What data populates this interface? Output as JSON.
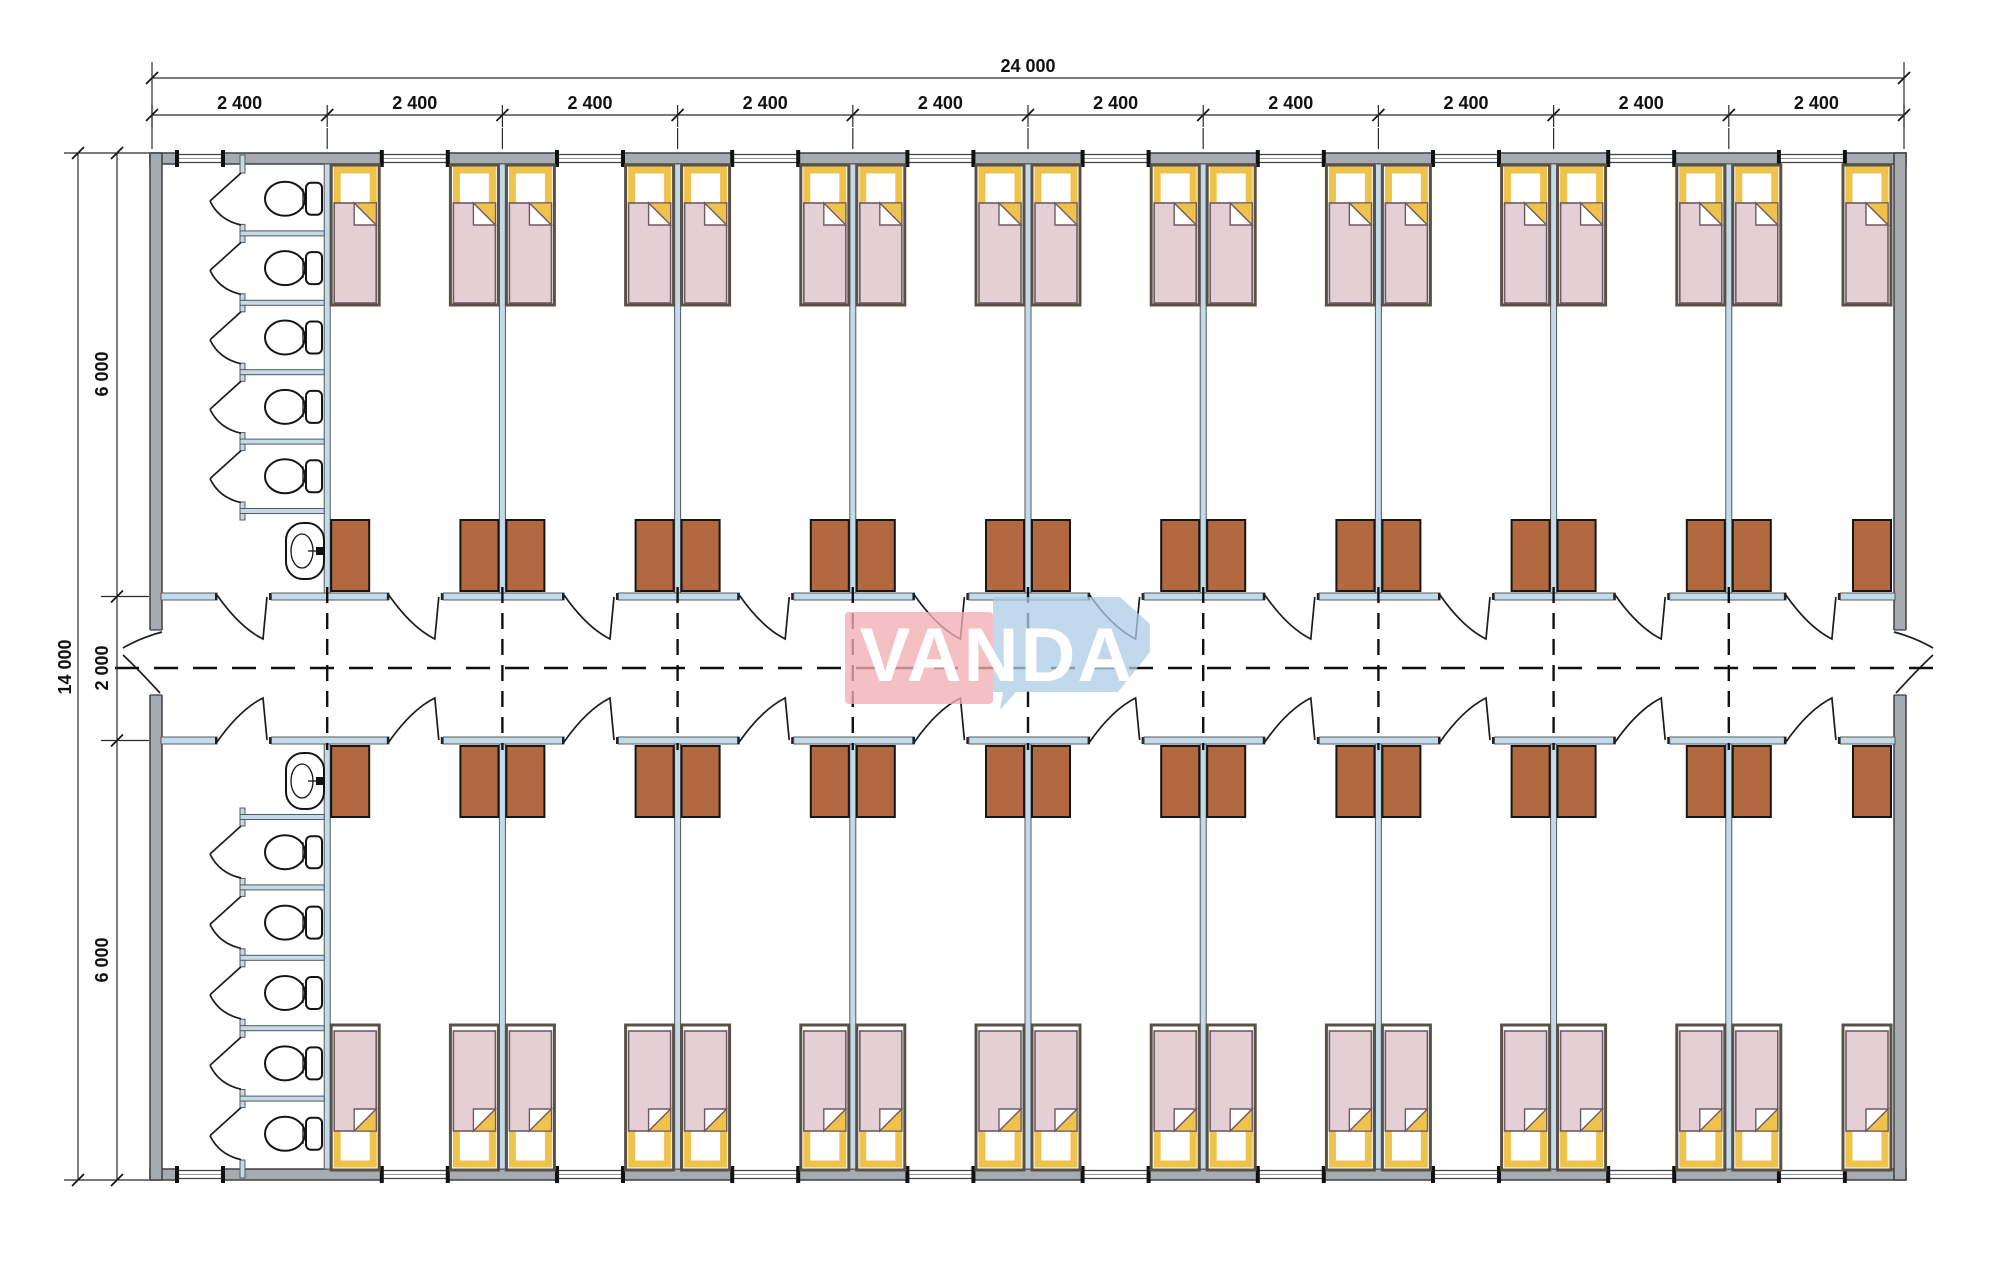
{
  "drawing": {
    "type": "dormitory-container-floor-plan"
  },
  "watermark": {
    "text": "VANDA",
    "pink": "#f2aeb3",
    "blue": "#aecbe6",
    "text_color": "#ffffff"
  },
  "dimensions": {
    "top_total": "24 000",
    "top_segments": [
      "2 400",
      "2 400",
      "2 400",
      "2 400",
      "2 400",
      "2 400",
      "2 400",
      "2 400",
      "2 400",
      "2 400"
    ],
    "left_total": "14 000",
    "left_segments": [
      "6 000",
      "2 000",
      "6 000"
    ]
  },
  "plan": {
    "building_mm": {
      "width": 24000,
      "depth": 14000
    },
    "bay_width_mm": 2400,
    "bays": 10,
    "wing_depth_mm": 6000,
    "corridor_width_mm": 2000,
    "wings": 2,
    "rooms_per_wing": 9,
    "beds_per_room": 2,
    "wardrobes_per_room": 2,
    "toilet_blocks": 2,
    "toilet_stalls_per_block": 5,
    "sinks_per_block": 1,
    "doors_per_room": 1,
    "corridor_end_exits": 2,
    "colors": {
      "wall": "#a7abaf",
      "wall_core": "#c3dbe9",
      "bed_frame": "#5a5146",
      "pillow_frame": "#eec24b",
      "blanket": "#e4cfd4",
      "wardrobe": "#b2693f"
    }
  }
}
